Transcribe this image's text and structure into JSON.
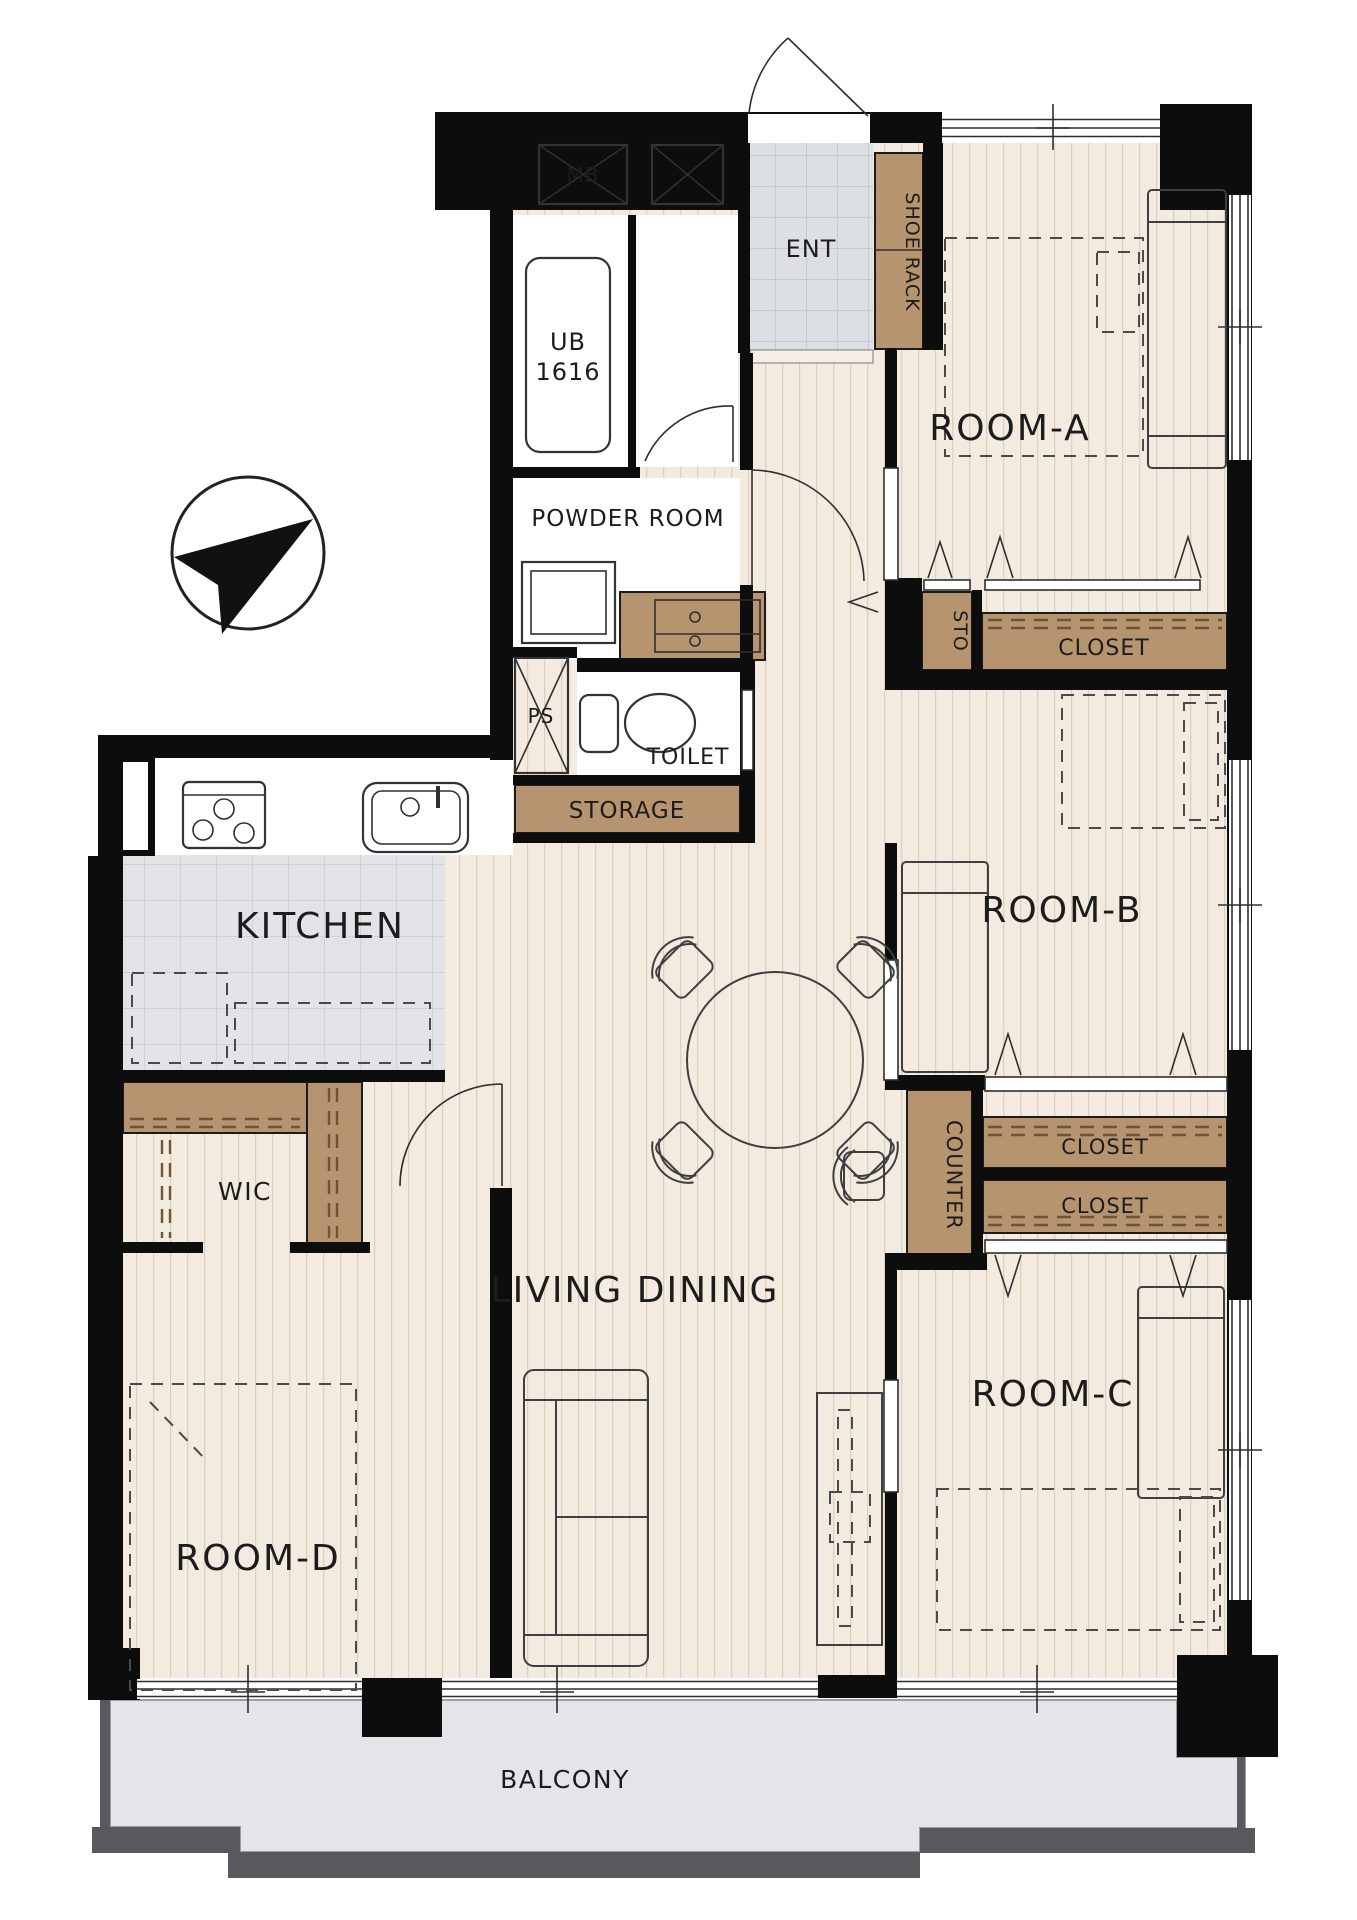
{
  "colors": {
    "wall": "#0d0d0d",
    "wood": "#f3ebe0",
    "wood_line": "#dcd1c1",
    "ent_tile": "#dcdfe3",
    "ent_tile_line": "#c0c4ca",
    "kitchen_tile": "#e2e3e6",
    "kitchen_tile_line": "#c9cbcf",
    "closet_brown": "#b6946f",
    "balcony_floor": "#e4e5e8",
    "balcony_rail": "#57595c",
    "fixture_blue": "#e9f3fa"
  },
  "labels": {
    "mb": "MB",
    "ent": "ENT",
    "shoe_rack": "SHOE RACK",
    "ub_line1": "UB",
    "ub_line2": "1616",
    "powder_room": "POWDER ROOM",
    "ps": "PS",
    "toilet": "TOILET",
    "storage": "STORAGE",
    "sto": "STO",
    "closet_a": "CLOSET",
    "closet_b": "CLOSET",
    "closet_c": "CLOSET",
    "room_a": "ROOM-A",
    "room_b": "ROOM-B",
    "room_c": "ROOM-C",
    "room_d": "ROOM-D",
    "kitchen": "KITCHEN",
    "wic": "WIC",
    "living_dining": "LIVING DINING",
    "counter": "COUNTER",
    "balcony": "BALCONY"
  }
}
